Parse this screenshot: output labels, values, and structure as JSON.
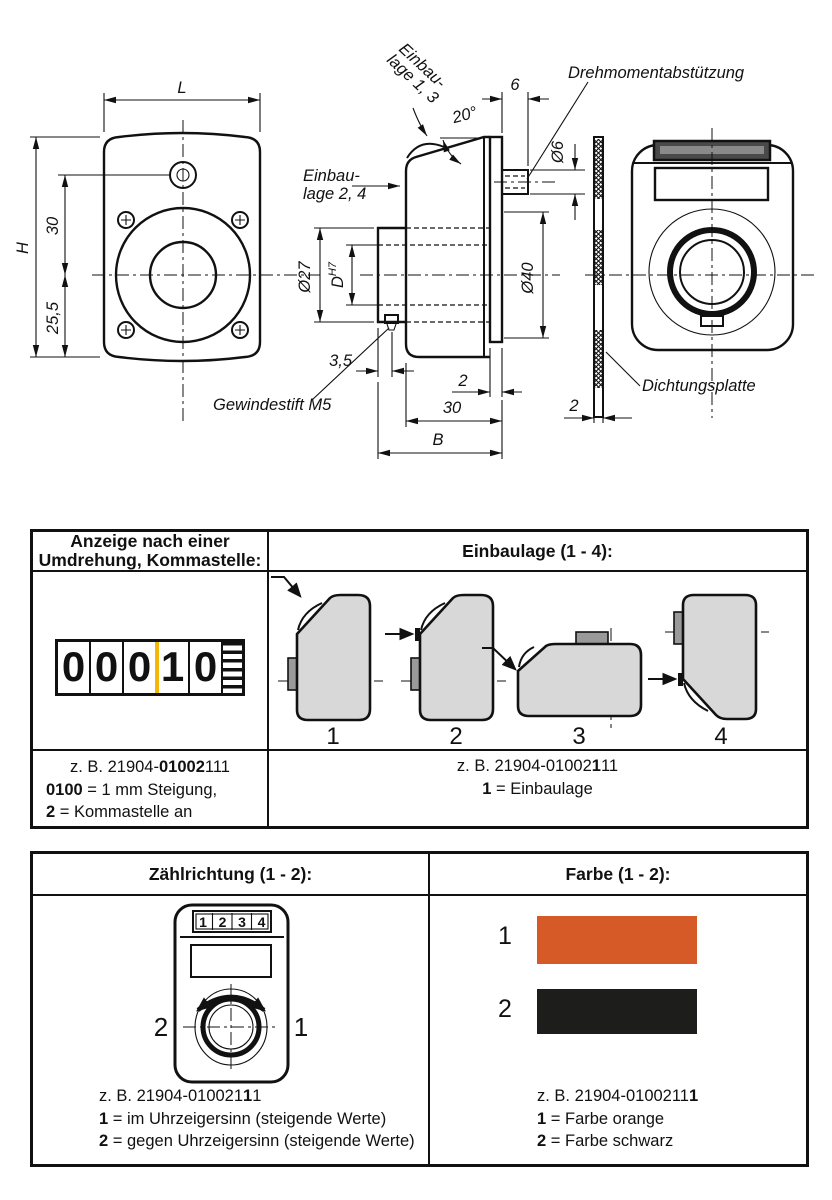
{
  "drawing": {
    "front": {
      "dim_width": "L",
      "dim_height": "H",
      "dim_30": "30",
      "dim_25_5": "25,5"
    },
    "side": {
      "einbaulage_13_l1": "Einbau-",
      "einbaulage_13_l2": "lage 1, 3",
      "einbaulage_24_l1": "Einbau-",
      "einbaulage_24_l2": "lage 2, 4",
      "angle": "20°",
      "dim_6": "6",
      "dia_6": "Ø6",
      "torque_label": "Drehmomentabstützung",
      "dia_27": "Ø27",
      "d_label": "D",
      "d_tolerance": "H7",
      "dia_40": "Ø40",
      "dim_3_5": "3,5",
      "set_screw_label": "Gewindestift M5",
      "dim_2": "2",
      "dim_30": "30",
      "dim_B": "B"
    },
    "seal": {
      "label": "Dichtungsplatte",
      "dim_2": "2"
    }
  },
  "table1": {
    "col1_header_line1": "Anzeige nach einer",
    "col1_header_line2": "Umdrehung, Kommastelle:",
    "col2_header": "Einbaulage (1 - 4):",
    "counter_digits": [
      "0",
      "0",
      "0",
      "1",
      "0"
    ],
    "comma_marker_color": "#f3b70a",
    "positions": [
      "1",
      "2",
      "3",
      "4"
    ],
    "col1_caption": {
      "l1a": "z. B. 21904-",
      "l1b": "01002",
      "l1c": "111",
      "l2a": "0100",
      "l2b": " = 1 mm Steigung,",
      "l3a": "2",
      "l3b": " = Kommastelle an",
      "l4": "2. Stelle von rechts"
    },
    "col2_caption": {
      "l1a": "z. B. 21904-01002",
      "l1b": "1",
      "l1c": "11",
      "l2a": "1",
      "l2b": " = Einbaulage"
    }
  },
  "table2": {
    "col1_header": "Zählrichtung (1 - 2):",
    "col2_header": "Farbe (1 - 2):",
    "device_digits": [
      "1",
      "2",
      "3",
      "4"
    ],
    "dir_left_label": "2",
    "dir_right_label": "1",
    "col1_caption": {
      "l1a": "z. B.  21904-010021",
      "l1b": "1",
      "l1c": "1",
      "l2a": "1",
      "l2b": " = im Uhrzeigersinn (steigende Werte)",
      "l3a": "2",
      "l3b": " = gegen Uhrzeigersinn (steigende Werte)"
    },
    "swatches": [
      {
        "label": "1",
        "name": "orange",
        "color": "#d55a28"
      },
      {
        "label": "2",
        "name": "schwarz",
        "color": "#1d1d1b"
      }
    ],
    "col2_caption": {
      "l1a": "z. B. 21904-0100211",
      "l1b": "1",
      "l2a": "1",
      "l2b": " = Farbe orange",
      "l3a": "2",
      "l3b": " = Farbe schwarz"
    }
  }
}
